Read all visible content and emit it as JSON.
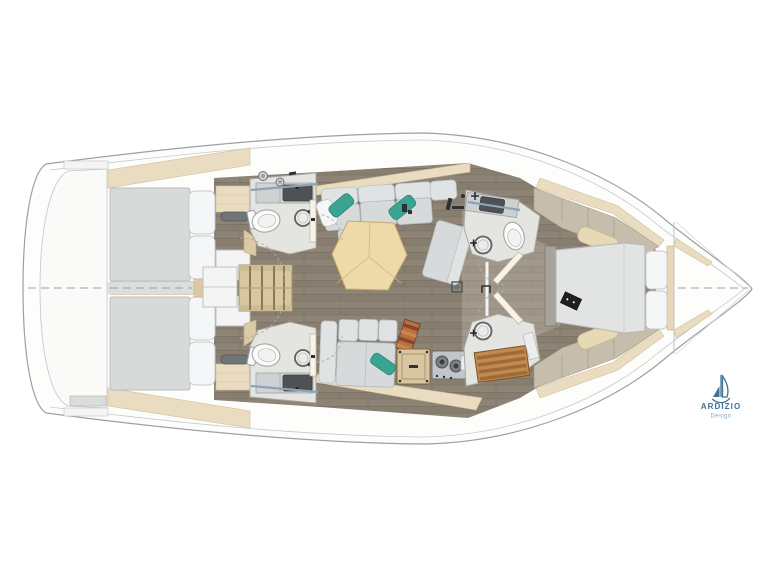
{
  "drawing": {
    "type": "yacht-interior-floor-plan",
    "orientation": "bow-right",
    "colors": {
      "background": "#ffffff",
      "hull_outline": "#9ba1a5",
      "deck_white": "#fdfdfc",
      "floor_wood": "#877d6f",
      "trim_beige": "#e9dcc0",
      "trim_beige_dark": "#dcc9a5",
      "upholstery_gray": "#d6dadb",
      "pillow_white": "#f5f6f7",
      "accent_teal": "#3aa392",
      "table_wood": "#eed9a9",
      "teak_grate": "#c08a50",
      "fixture_white": "#fbfbfa",
      "hardware_dark": "#2e3234"
    },
    "areas": [
      {
        "name": "swim-platform"
      },
      {
        "name": "aft-cabin-starboard"
      },
      {
        "name": "aft-cabin-port"
      },
      {
        "name": "companionway-steps"
      },
      {
        "name": "head-aft-starboard"
      },
      {
        "name": "head-aft-port"
      },
      {
        "name": "salon-sofa"
      },
      {
        "name": "salon-table"
      },
      {
        "name": "galley"
      },
      {
        "name": "head-forward"
      },
      {
        "name": "shower-forward"
      },
      {
        "name": "owner-cabin"
      },
      {
        "name": "bow"
      }
    ]
  },
  "logo": {
    "brand": "ARDIZIO",
    "subtitle": "Design",
    "color": "#3f7296",
    "subtitle_color": "#85a8c4",
    "icon": "sailboat-icon"
  }
}
